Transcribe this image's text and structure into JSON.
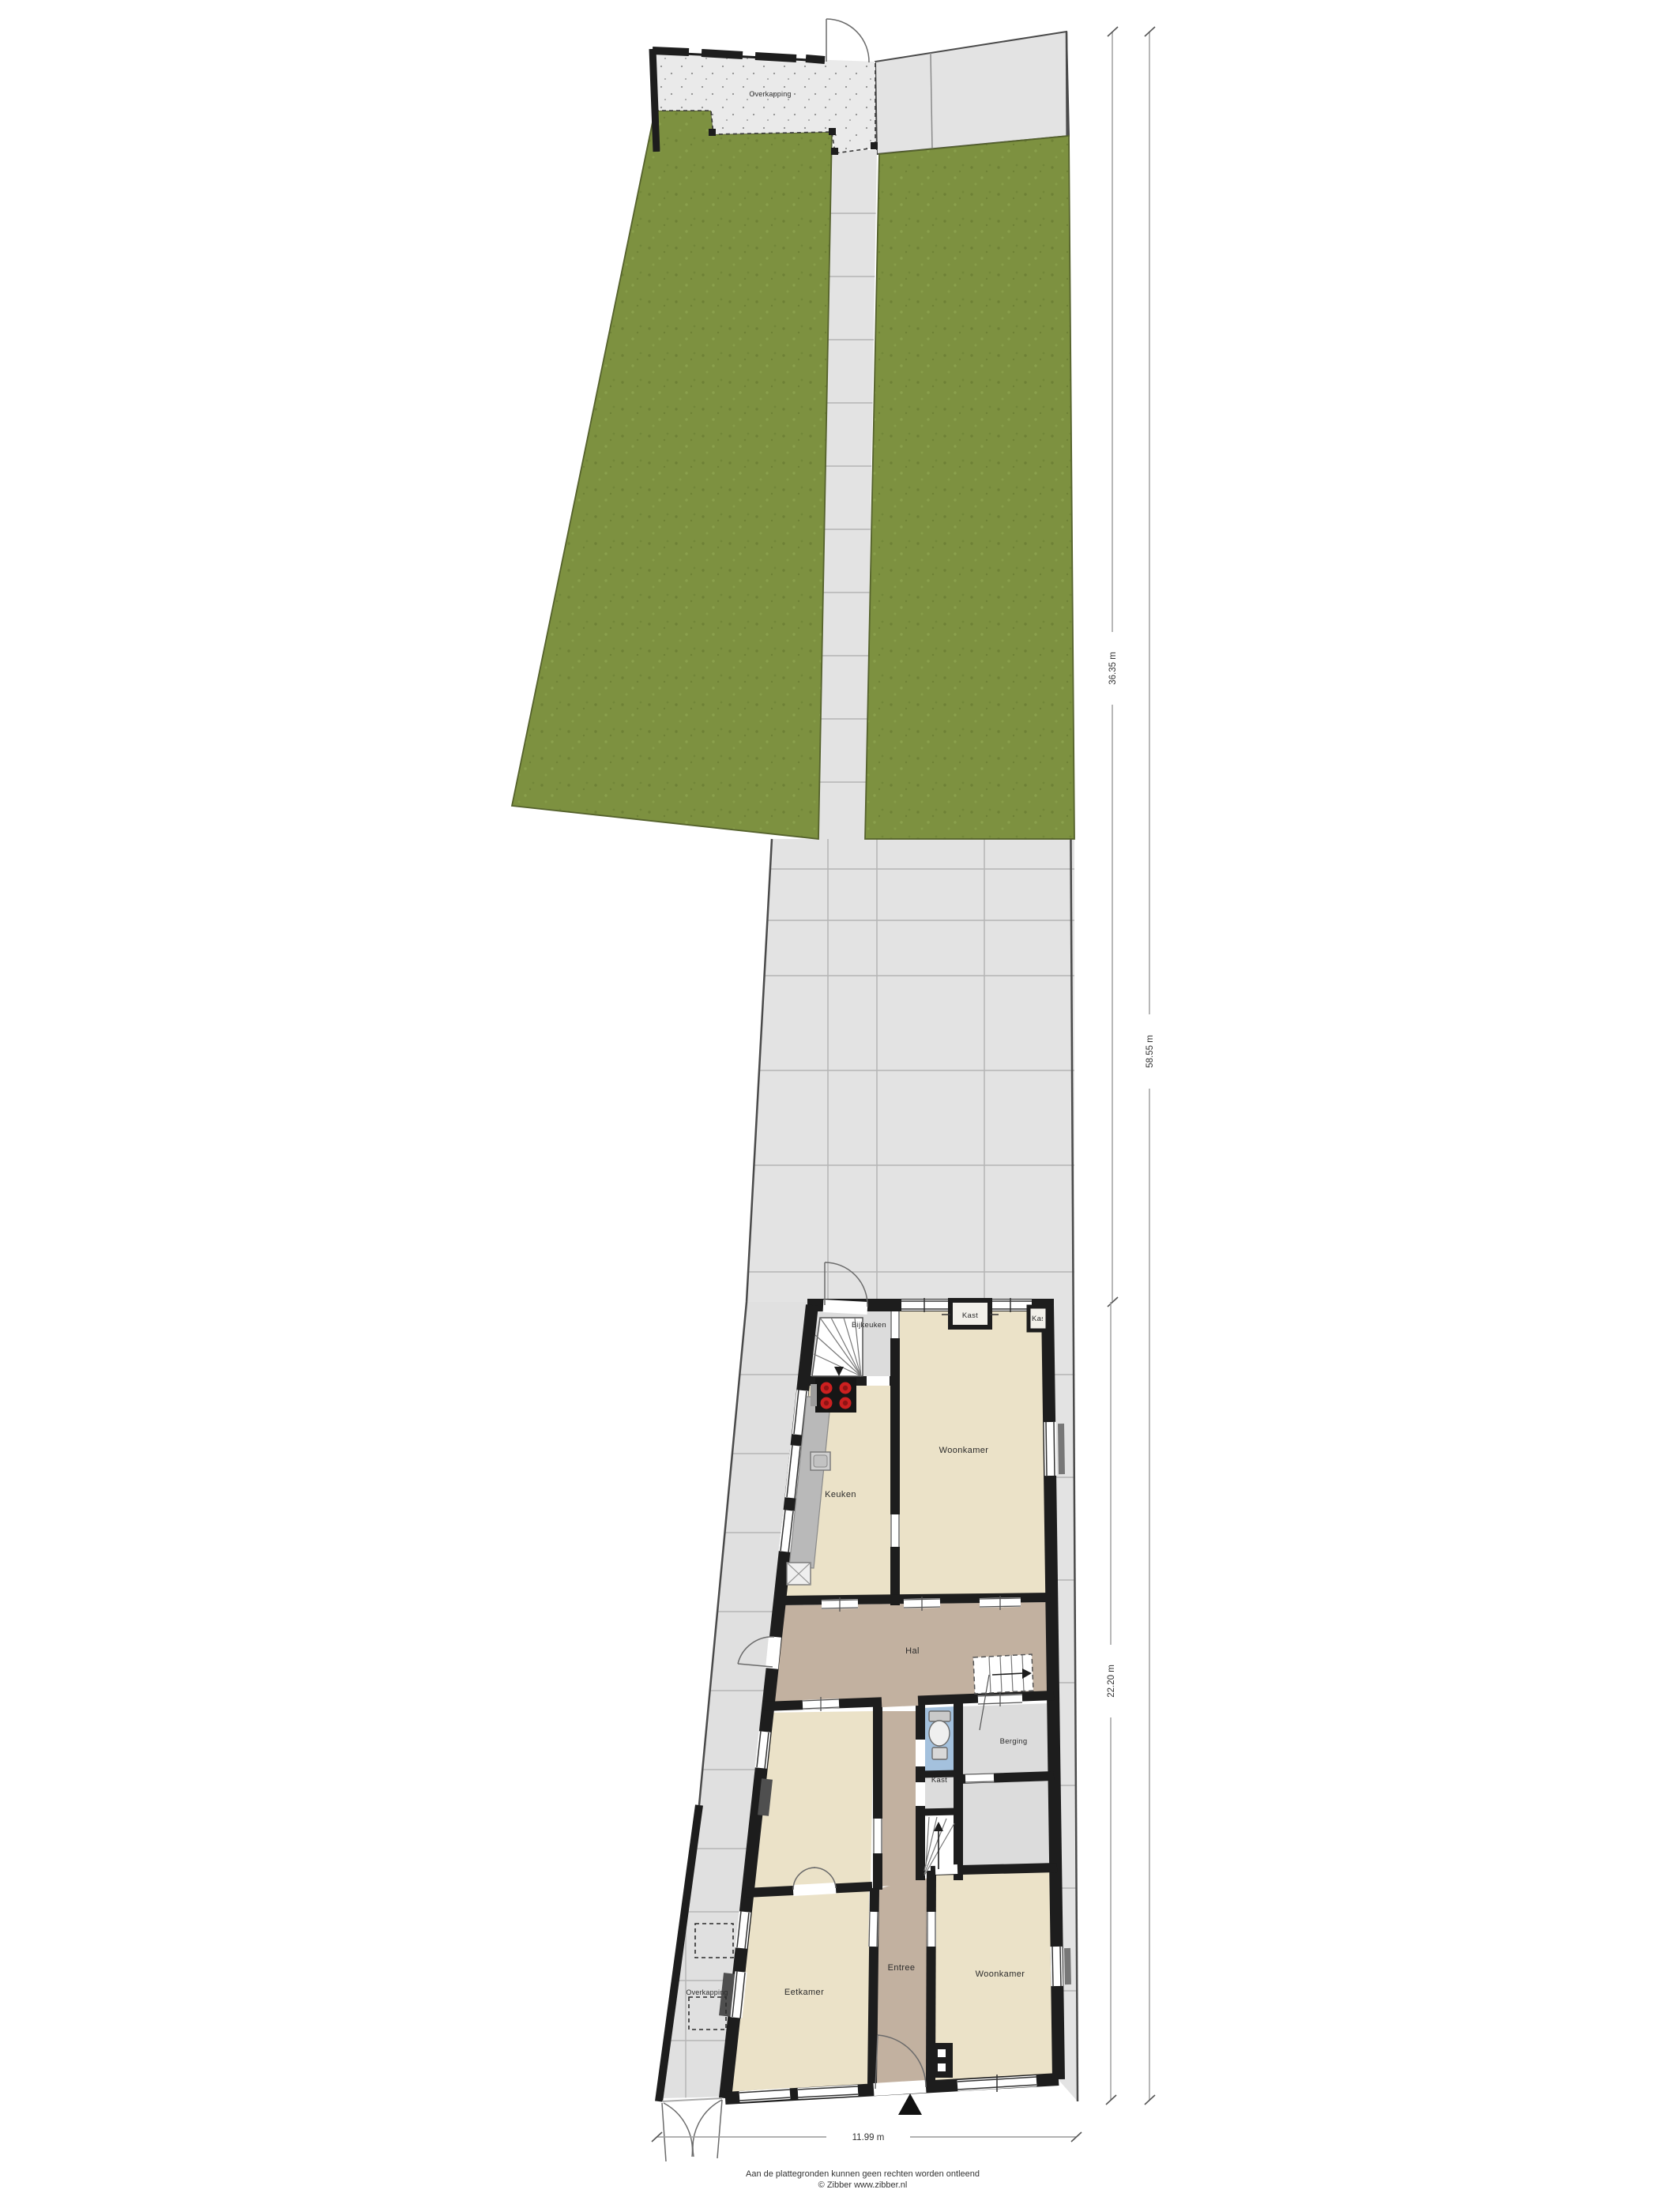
{
  "site": {
    "overkapping_top_label": "Overkapping",
    "overkapping_side_label": "Overkapping"
  },
  "rooms": {
    "bijkeuken": "Bijkeuken",
    "kast_top": "Kast",
    "kast_top_right": "Kast",
    "woonkamer_top": "Woonkamer",
    "keuken": "Keuken",
    "hal": "Hal",
    "kast_mid": "Kast",
    "berging": "Berging",
    "eetkamer": "Eetkamer",
    "entree": "Entree",
    "woonkamer_bottom": "Woonkamer"
  },
  "dimensions": {
    "garden_depth": "36.35 m",
    "house_depth": "22.20 m",
    "total_depth": "58.55 m",
    "width": "11.99 m"
  },
  "footer": {
    "disclaimer": "Aan de plattegronden kunnen geen rechten worden ontleend",
    "credit": "© Zibber www.zibber.nl"
  },
  "icons": {
    "north_arrow": "north-arrow",
    "toilet": "toilet",
    "stairs": "stairs",
    "cooktop": "cooktop",
    "sink": "sink"
  },
  "colors": {
    "grass": "#7d9140",
    "paving": "#e3e3e3",
    "paving_grid": "#b5b5b5",
    "boundary": "#4a4a4a",
    "floor_cream": "#ebe2c8",
    "floor_hall_brown": "#c2b1a0",
    "floor_gray": "#dcdcdc",
    "toilet_blue": "#a4c1dd",
    "wall_black": "#1d1d1d",
    "burner_red": "#cc2020"
  }
}
